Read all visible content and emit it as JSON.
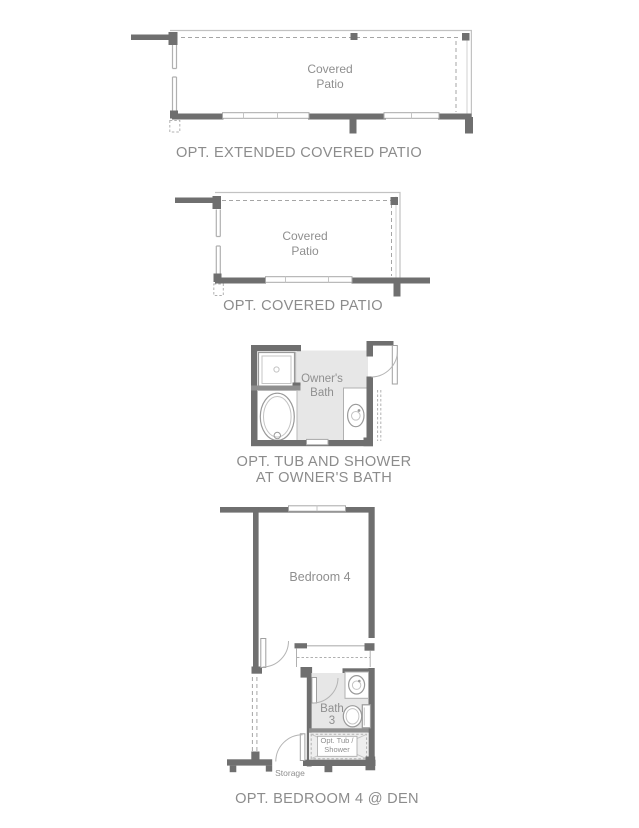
{
  "sheet_title": "Floor plan options",
  "colors": {
    "background": "#ffffff",
    "wall_dark": "#6f6f6f",
    "wall_medium": "#8f8f8f",
    "roof_line": "#c2c2c2",
    "dashed_line": "#a5a5a5",
    "floor_shade": "#e7e7e7",
    "label_text": "#8c8c8c",
    "room_text": "#8f8f8f"
  },
  "plans": [
    {
      "name": "extended-covered-patio",
      "caption": "OPT. EXTENDED COVERED PATIO",
      "room_line1": "Covered",
      "room_line2": "Patio"
    },
    {
      "name": "covered-patio",
      "caption": "OPT. COVERED PATIO",
      "room_line1": "Covered",
      "room_line2": "Patio"
    },
    {
      "name": "tub-and-shower-at-owners-bath",
      "caption_line1": "OPT. TUB AND SHOWER",
      "caption_line2": "AT OWNER'S BATH",
      "room_line1": "Owner's",
      "room_line2": "Bath"
    },
    {
      "name": "bedroom-4-at-den",
      "caption": "OPT. BEDROOM 4 @ DEN",
      "bedroom_label": "Bedroom 4",
      "bath_line1": "Bath",
      "bath_line2": "3",
      "tub_line1": "Opt. Tub /",
      "tub_line2": "Shower",
      "storage_label": "Storage"
    }
  ]
}
